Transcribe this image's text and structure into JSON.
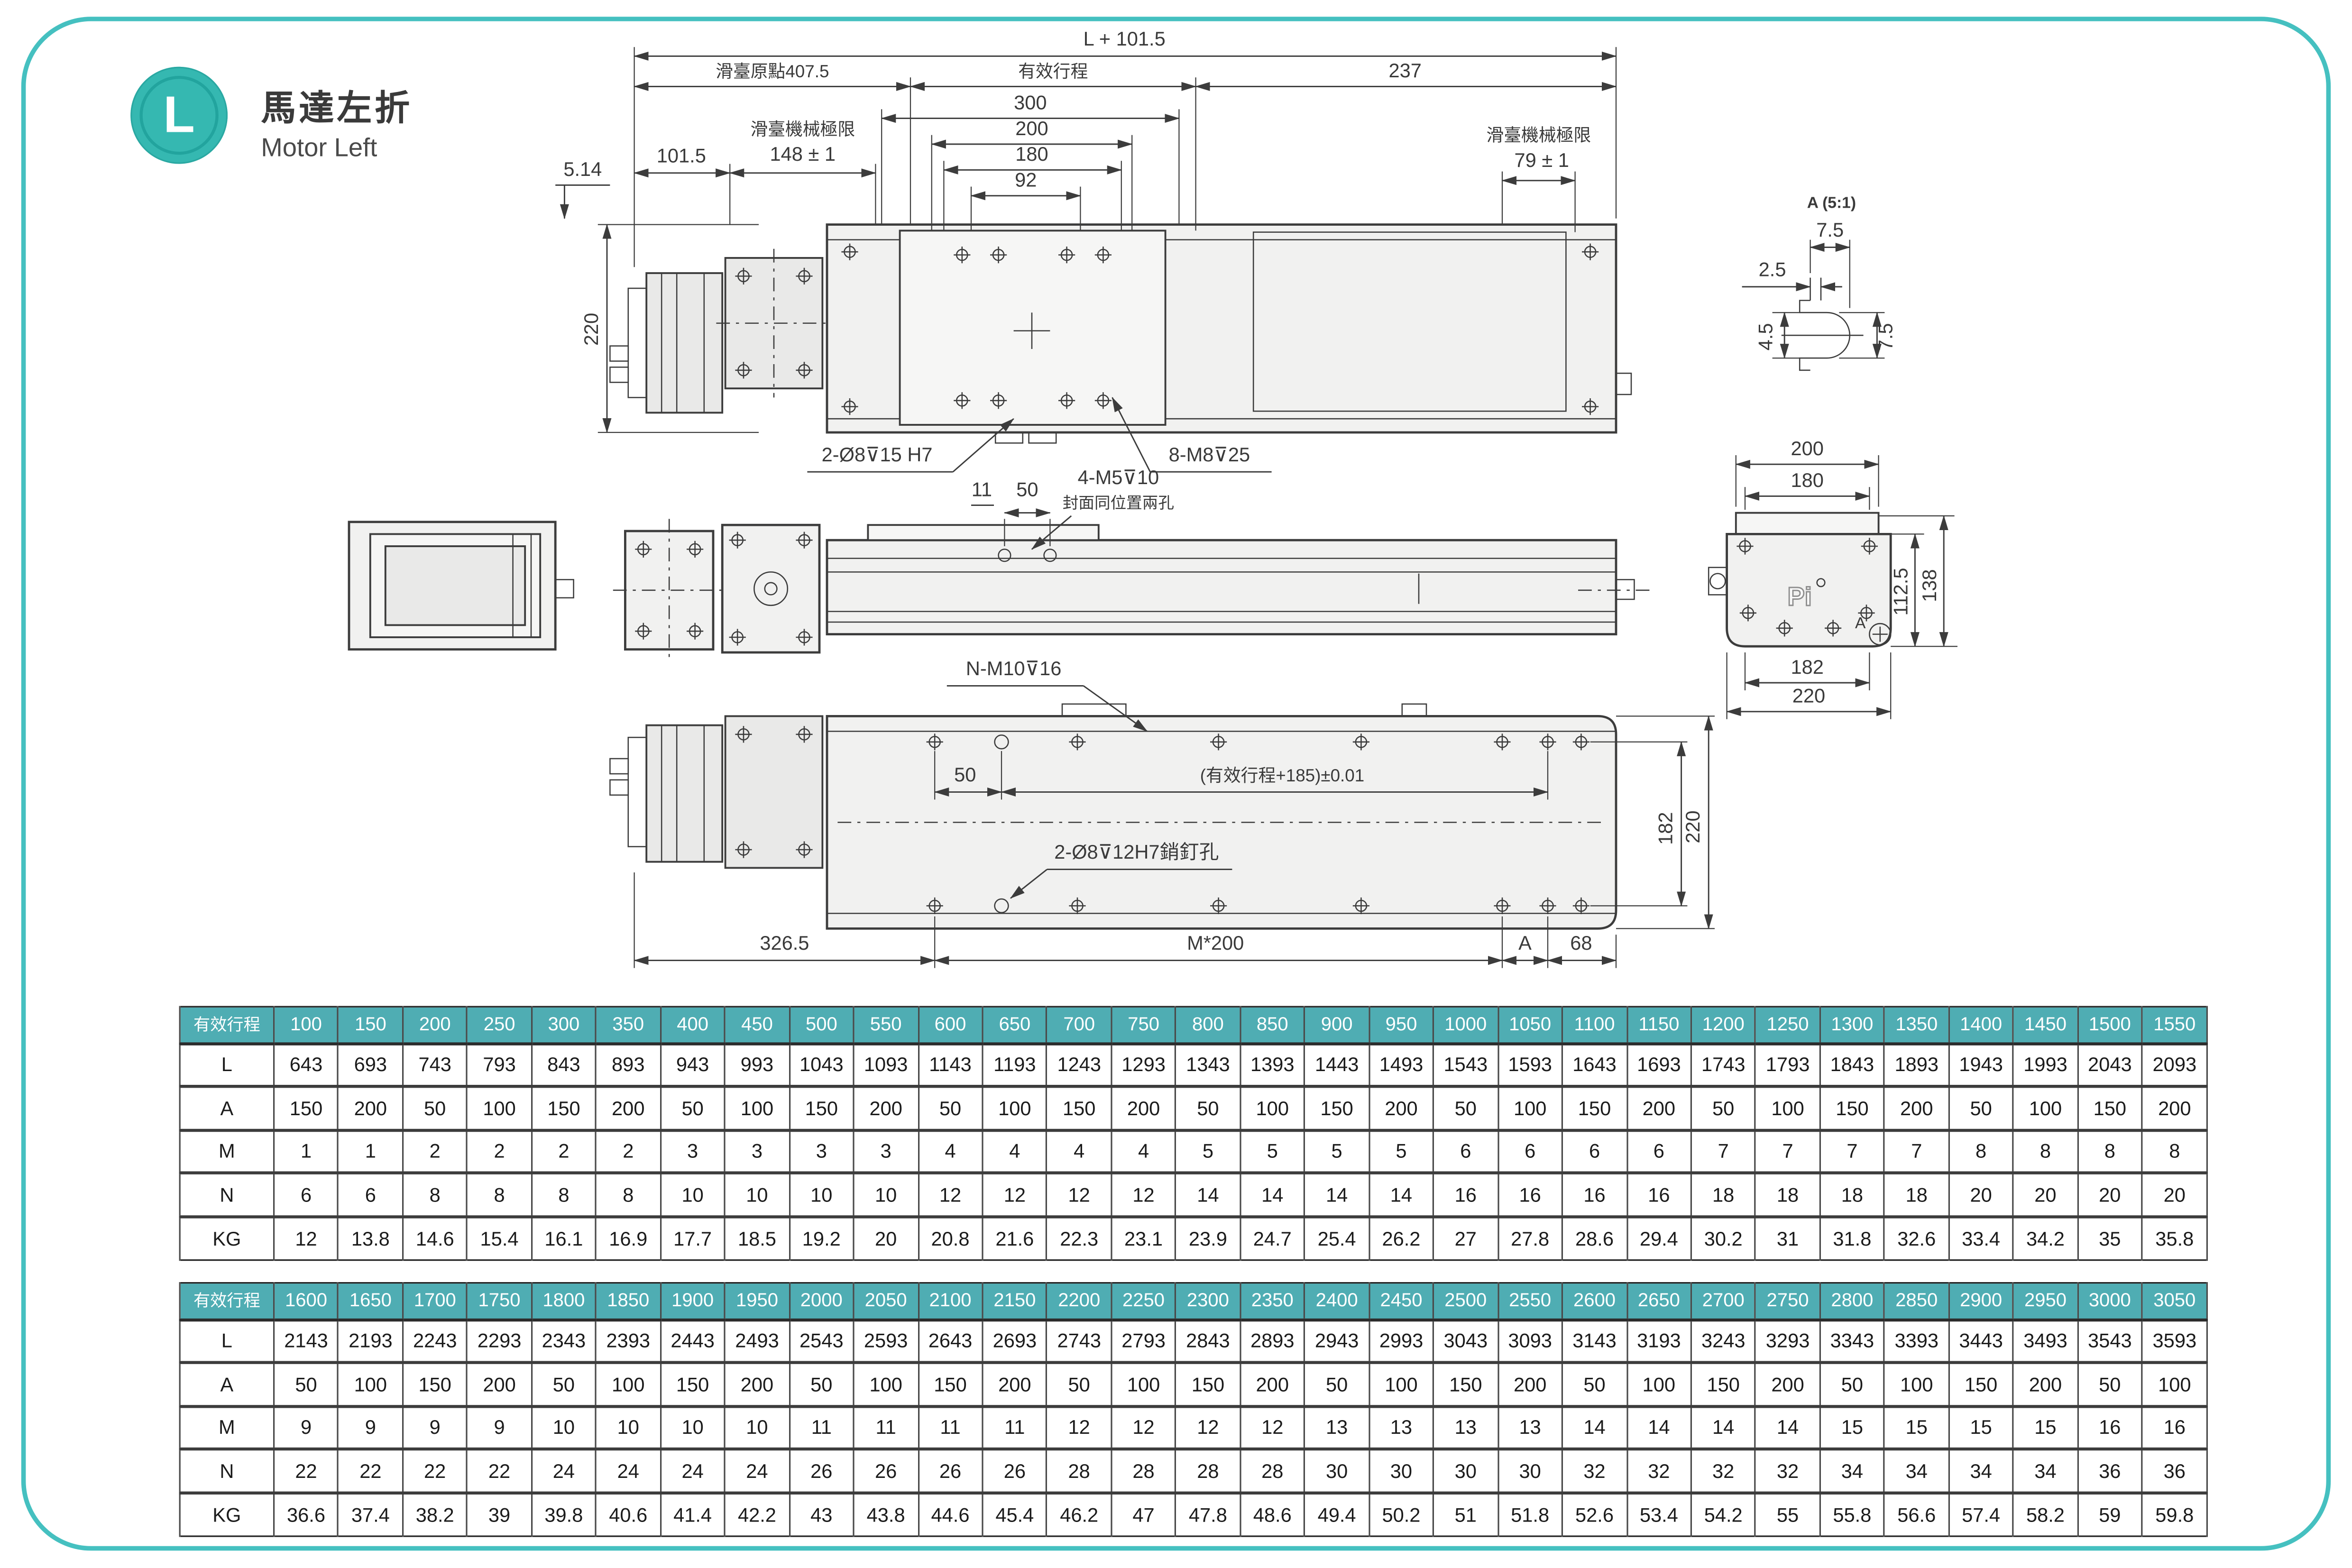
{
  "page": {
    "badge": "L",
    "title_zh": "馬達左折",
    "title_en": "Motor Left",
    "colors": {
      "accent_teal": "#35b8b1",
      "table_header_teal": "#4fadb3",
      "frame_teal": "#45c0c0"
    }
  },
  "drawing": {
    "top": {
      "total": "L + 101.5",
      "origin": "滑臺原點407.5",
      "stroke": "有效行程",
      "right": "237",
      "d300": "300",
      "d200": "200",
      "d180": "180",
      "d92": "92",
      "d101": "101.5",
      "limit": "滑臺機械極限",
      "d148": "148 ± 1",
      "d79": "79 ± 1",
      "d514": "5.14",
      "d220": "220",
      "pin": "2-Ø8⊽15  H7",
      "m8": "8-M8⊽25"
    },
    "side": {
      "d11": "11",
      "d50": "50",
      "m5": "4-M5⊽10",
      "m5note": "封面同位置兩孔"
    },
    "end": {
      "d200": "200",
      "d180": "180",
      "d1125": "112.5",
      "d138": "138",
      "d182": "182",
      "d220": "220",
      "logo": "Pi",
      "ref": "A"
    },
    "bottom": {
      "m10": "N-M10⊽16",
      "d50": "50",
      "tol": "(有效行程+185)±0.01",
      "pin": "2-Ø8⊽12H7銷釘孔",
      "d3265": "326.5",
      "m200": "M*200",
      "dA": "A",
      "d68": "68",
      "d182": "182",
      "d220": "220"
    },
    "detailA": {
      "title": "A (5:1)",
      "top75": "7.5",
      "d25": "2.5",
      "d45": "4.5",
      "right75": "7.5"
    }
  },
  "tables": [
    {
      "header_label": "有效行程",
      "strokes": [
        100,
        150,
        200,
        250,
        300,
        350,
        400,
        450,
        500,
        550,
        600,
        650,
        700,
        750,
        800,
        850,
        900,
        950,
        1000,
        1050,
        1100,
        1150,
        1200,
        1250,
        1300,
        1350,
        1400,
        1450,
        1500,
        1550
      ],
      "rows": [
        {
          "label": "L",
          "values": [
            643,
            693,
            743,
            793,
            843,
            893,
            943,
            993,
            1043,
            1093,
            1143,
            1193,
            1243,
            1293,
            1343,
            1393,
            1443,
            1493,
            1543,
            1593,
            1643,
            1693,
            1743,
            1793,
            1843,
            1893,
            1943,
            1993,
            2043,
            2093
          ]
        },
        {
          "label": "A",
          "values": [
            150,
            200,
            50,
            100,
            150,
            200,
            50,
            100,
            150,
            200,
            50,
            100,
            150,
            200,
            50,
            100,
            150,
            200,
            50,
            100,
            150,
            200,
            50,
            100,
            150,
            200,
            50,
            100,
            150,
            200
          ]
        },
        {
          "label": "M",
          "values": [
            1,
            1,
            2,
            2,
            2,
            2,
            3,
            3,
            3,
            3,
            4,
            4,
            4,
            4,
            5,
            5,
            5,
            5,
            6,
            6,
            6,
            6,
            7,
            7,
            7,
            7,
            8,
            8,
            8,
            8
          ]
        },
        {
          "label": "N",
          "values": [
            6,
            6,
            8,
            8,
            8,
            8,
            10,
            10,
            10,
            10,
            12,
            12,
            12,
            12,
            14,
            14,
            14,
            14,
            16,
            16,
            16,
            16,
            18,
            18,
            18,
            18,
            20,
            20,
            20,
            20
          ]
        },
        {
          "label": "KG",
          "values": [
            12,
            13.8,
            14.6,
            15.4,
            16.1,
            16.9,
            17.7,
            18.5,
            19.2,
            20,
            20.8,
            21.6,
            22.3,
            23.1,
            23.9,
            24.7,
            25.4,
            26.2,
            27,
            27.8,
            28.6,
            29.4,
            30.2,
            31,
            31.8,
            32.6,
            33.4,
            34.2,
            35,
            35.8
          ]
        }
      ]
    },
    {
      "header_label": "有效行程",
      "strokes": [
        1600,
        1650,
        1700,
        1750,
        1800,
        1850,
        1900,
        1950,
        2000,
        2050,
        2100,
        2150,
        2200,
        2250,
        2300,
        2350,
        2400,
        2450,
        2500,
        2550,
        2600,
        2650,
        2700,
        2750,
        2800,
        2850,
        2900,
        2950,
        3000,
        3050
      ],
      "rows": [
        {
          "label": "L",
          "values": [
            2143,
            2193,
            2243,
            2293,
            2343,
            2393,
            2443,
            2493,
            2543,
            2593,
            2643,
            2693,
            2743,
            2793,
            2843,
            2893,
            2943,
            2993,
            3043,
            3093,
            3143,
            3193,
            3243,
            3293,
            3343,
            3393,
            3443,
            3493,
            3543,
            3593
          ]
        },
        {
          "label": "A",
          "values": [
            50,
            100,
            150,
            200,
            50,
            100,
            150,
            200,
            50,
            100,
            150,
            200,
            50,
            100,
            150,
            200,
            50,
            100,
            150,
            200,
            50,
            100,
            150,
            200,
            50,
            100,
            150,
            200,
            50,
            100
          ]
        },
        {
          "label": "M",
          "values": [
            9,
            9,
            9,
            9,
            10,
            10,
            10,
            10,
            11,
            11,
            11,
            11,
            12,
            12,
            12,
            12,
            13,
            13,
            13,
            13,
            14,
            14,
            14,
            14,
            15,
            15,
            15,
            15,
            16,
            16
          ]
        },
        {
          "label": "N",
          "values": [
            22,
            22,
            22,
            22,
            24,
            24,
            24,
            24,
            26,
            26,
            26,
            26,
            28,
            28,
            28,
            28,
            30,
            30,
            30,
            30,
            32,
            32,
            32,
            32,
            34,
            34,
            34,
            34,
            36,
            36
          ]
        },
        {
          "label": "KG",
          "values": [
            36.6,
            37.4,
            38.2,
            39,
            39.8,
            40.6,
            41.4,
            42.2,
            43,
            43.8,
            44.6,
            45.4,
            46.2,
            47,
            47.8,
            48.6,
            49.4,
            50.2,
            51,
            51.8,
            52.6,
            53.4,
            54.2,
            55,
            55.8,
            56.6,
            57.4,
            58.2,
            59,
            59.8
          ]
        }
      ]
    }
  ]
}
